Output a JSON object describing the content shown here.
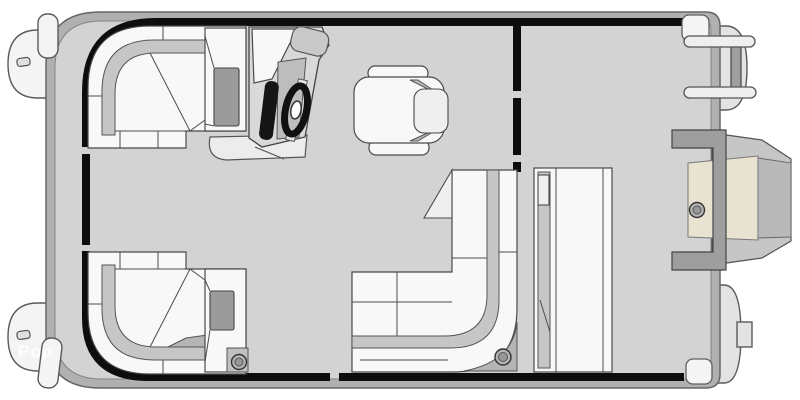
{
  "watermark": {
    "text": "Pop"
  },
  "colors": {
    "bg": "#ffffff",
    "deck": "#d3d3d3",
    "deck-edge": "#b0b0b0",
    "fence": "#0d0d0d",
    "cushion": "#f8f8f8",
    "trim": "#c6c6c6",
    "trim-dark": "#b5b5b5",
    "table": "#9b9b9b",
    "tube": "#f4f4f4",
    "motor-tan": "#e8e2d1",
    "motor-gray": "#c6c6c6",
    "mount-gray": "#9e9e9e",
    "dash": "#151515"
  },
  "components": [
    {
      "name": "deck",
      "label": "pontoon-deck"
    },
    {
      "name": "pontoon-nose-top",
      "label": "pontoon-tube-nose-cone"
    },
    {
      "name": "pontoon-nose-bottom",
      "label": "pontoon-tube-nose-cone"
    },
    {
      "name": "pontoon-stern-top",
      "label": "pontoon-tube-stern-end"
    },
    {
      "name": "pontoon-stern-bottom",
      "label": "pontoon-tube-stern-end"
    },
    {
      "name": "bow-gate",
      "label": "bow-boarding-gate"
    },
    {
      "name": "stern-partition",
      "label": "stern-fence-partition"
    },
    {
      "name": "bow-lounge-top",
      "label": "l-shaped-bow-lounge"
    },
    {
      "name": "bow-lounge-bottom",
      "label": "l-shaped-bow-lounge"
    },
    {
      "name": "helm-console",
      "label": "helm-console"
    },
    {
      "name": "steering-wheel",
      "label": "steering-wheel"
    },
    {
      "name": "captain-chair",
      "label": "captain-chair"
    },
    {
      "name": "aft-lounge",
      "label": "l-shaped-aft-lounge"
    },
    {
      "name": "stern-bench",
      "label": "stern-bench"
    },
    {
      "name": "boarding-ladder",
      "label": "stern-boarding-ladder"
    },
    {
      "name": "outboard-motor",
      "label": "outboard-motor"
    },
    {
      "name": "cup-holder",
      "label": "cup-holder"
    }
  ]
}
